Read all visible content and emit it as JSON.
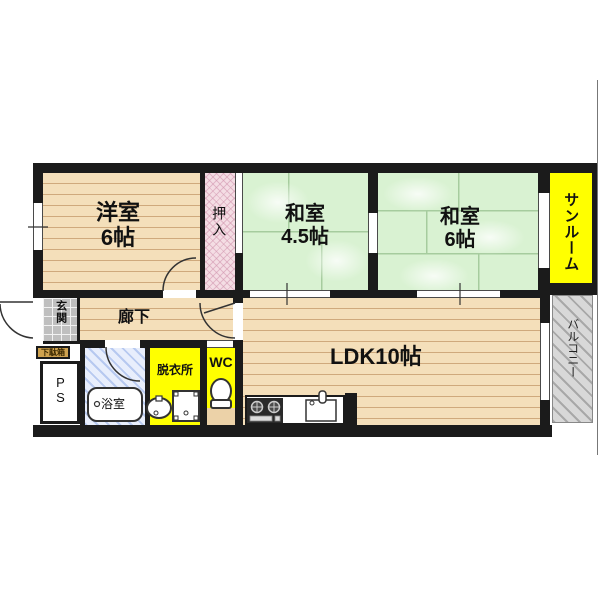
{
  "floorplan": {
    "rooms": {
      "western_room": {
        "name": "洋室",
        "size": "6帖"
      },
      "closet": {
        "label": "押入"
      },
      "japanese_room_small": {
        "name": "和室",
        "size": "4.5帖"
      },
      "japanese_room_large": {
        "name": "和室",
        "size": "6帖"
      },
      "sunroom": {
        "label": "サンルーム"
      },
      "entrance": {
        "label": "玄関"
      },
      "shoe_cabinet": {
        "label": "下駄箱"
      },
      "pipe_space": {
        "label": "PS"
      },
      "hallway": {
        "label": "廊下"
      },
      "bathroom": {
        "label": "浴室"
      },
      "dressing_room": {
        "label": "脱衣所"
      },
      "toilet": {
        "label": "WC"
      },
      "ldk": {
        "label": "LDK10帖"
      },
      "balcony": {
        "label": "バルコニー"
      }
    },
    "colors": {
      "wall": "#1b1b1b",
      "wood_floor": "#f4dfba",
      "tatami_green": "#d9f2d2",
      "closet_pink": "#f4dde4",
      "accent_yellow": "#ffff00",
      "bathroom_blue": "#e8eefc",
      "balcony_gray": "#d8d8d8",
      "shoe_cabinet_tan": "#cfa24f"
    }
  }
}
